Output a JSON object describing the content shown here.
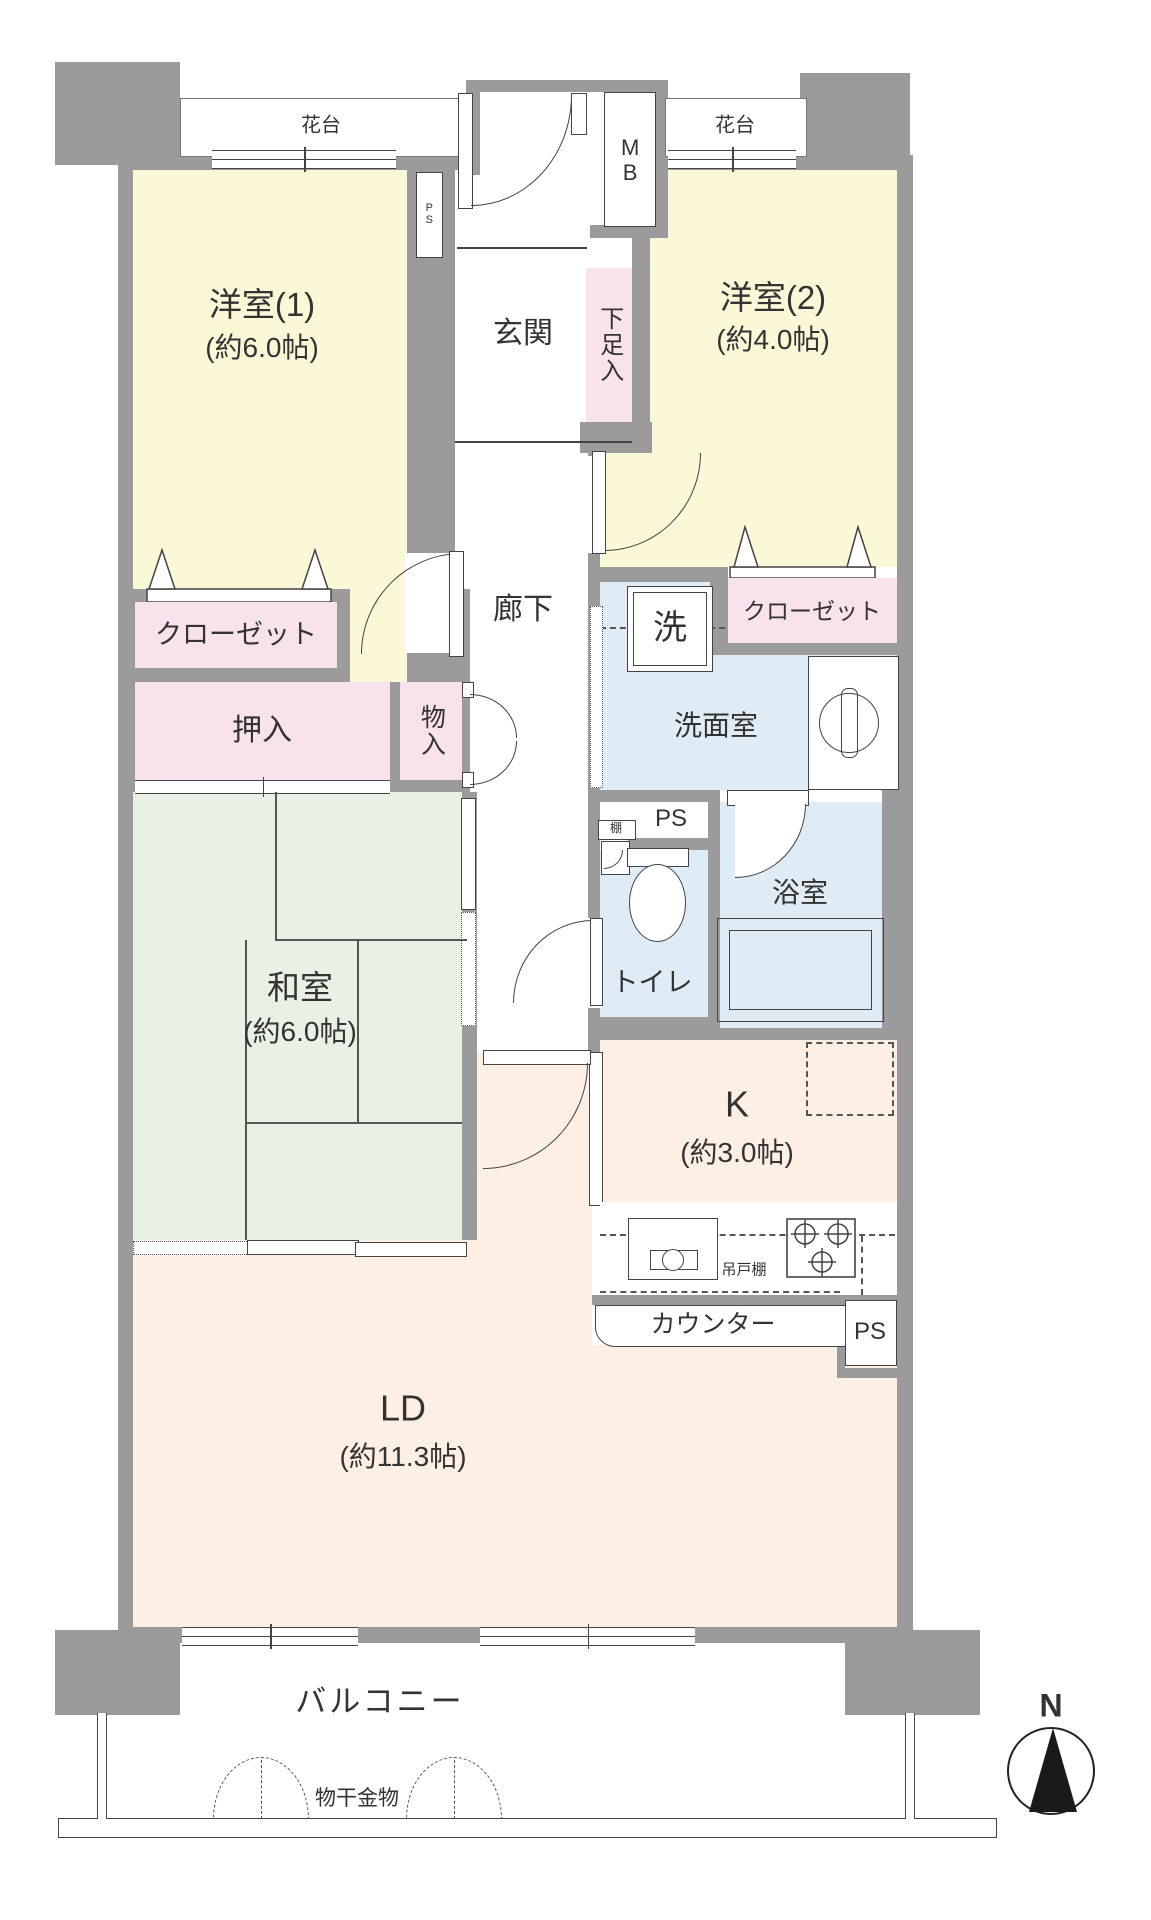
{
  "colors": {
    "wall": "#9b9b9b",
    "western_room": "#fbf8d8",
    "storage": "#f8e2ec",
    "tatami_room": "#e9f1e4",
    "wet_area": "#dfecf6",
    "living": "#fdefe4",
    "line": "#444444",
    "text": "#333333"
  },
  "rooms": {
    "yoshitsu1": {
      "name": "洋室(1)",
      "size": "(約6.0帖)"
    },
    "yoshitsu2": {
      "name": "洋室(2)",
      "size": "(約4.0帖)"
    },
    "washitsu": {
      "name": "和室",
      "size": "(約6.0帖)"
    },
    "kitchen": {
      "name": "K",
      "size": "(約3.0帖)"
    },
    "living": {
      "name": "LD",
      "size": "(約11.3帖)"
    },
    "genkan": "玄関",
    "rouka": "廊下",
    "senmenshitsu": "洗面室",
    "yokushitsu": "浴室",
    "toire": "トイレ",
    "balcony": "バルコニー"
  },
  "storage": {
    "closet1": "クローゼット",
    "closet2": "クローゼット",
    "oshiire": "押入",
    "monoiri": "物入",
    "shitasokuiri": "下足入",
    "tana": "棚",
    "tsuridotana": "吊戸棚"
  },
  "fixtures": {
    "hanadai_left": "花台",
    "hanadai_right": "花台",
    "mb": "MB",
    "ps_top": "PS",
    "ps_mid": "PS",
    "ps_kitchen": "PS",
    "sentakuki": "洗",
    "counter": "カウンター",
    "monohoshi": "物干金物"
  },
  "compass": {
    "north": "N"
  }
}
